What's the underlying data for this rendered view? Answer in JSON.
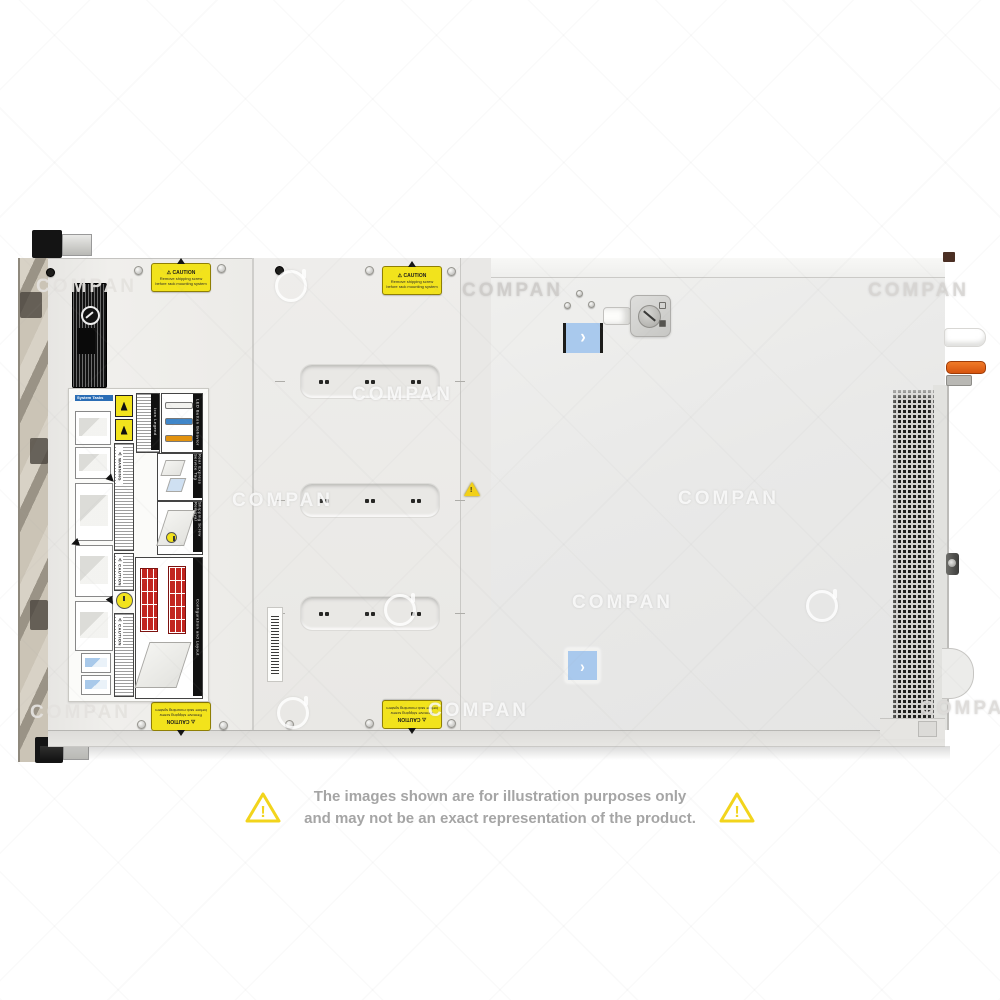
{
  "watermark": {
    "text": "COMPAN"
  },
  "disclaimer": {
    "line1": "The images shown are for illustration purposes only",
    "line2": "and may not be an exact representation of the product."
  },
  "server": {
    "caution_sticker": {
      "glyph": "⚠",
      "title": "CAUTION",
      "line1": "Remove shipping screw",
      "line2": "before rack mounting system"
    },
    "labels": {
      "system_tasks": "System Tasks",
      "icon_legend": "Icon Legend",
      "led_behavior": "LED Button Behavior",
      "rear_express_tag": "Rear Express Service Tag",
      "shipping_screw": "Shipping Screw Removal",
      "config_layout": "Configuration and Layout",
      "warning_word": "⚠ WARNING",
      "caution_word": "⚠ CAUTION"
    },
    "icons": {
      "chevron_right": "›"
    },
    "colors": {
      "latch_blue": "#a9c9ed",
      "caution_yellow": "#f2e31c",
      "handle_orange": "#e06418",
      "led_blue": "#3f86c9",
      "led_orange": "#e2920e",
      "drive_red": "#c2251f"
    }
  }
}
